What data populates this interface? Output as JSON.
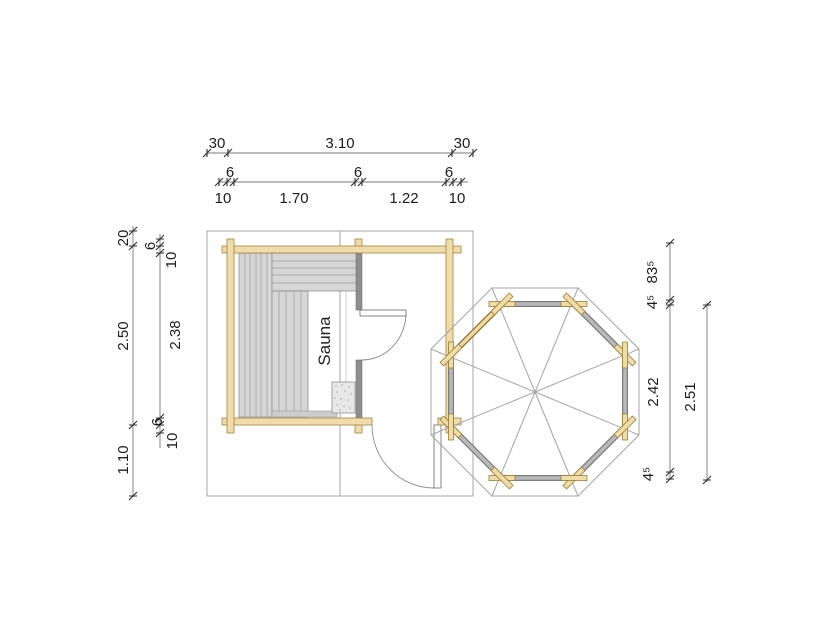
{
  "plan": {
    "room_label": "Sauna"
  },
  "dimensions": {
    "top": {
      "row1": [
        "30",
        "3.10",
        "30"
      ],
      "row2": [
        "6",
        "6",
        "6"
      ],
      "row3": [
        "10",
        "1.70",
        "1.22",
        "10"
      ]
    },
    "left": {
      "outer": [
        "20",
        "2.50",
        "1.10"
      ],
      "inner": [
        "6",
        "10",
        "2.38",
        "6",
        "10"
      ]
    },
    "right": {
      "inner": [
        "83⁵",
        "4⁵",
        "2.42",
        "4⁵"
      ],
      "outer": [
        "2.51"
      ]
    }
  },
  "colors": {
    "wood": "#f0dcaa",
    "wood_border": "#9c7c34",
    "bench_gray": "#d6d6d6",
    "wall_gray": "#8e8e8e",
    "octagon_wall_gray": "#b9b9b9",
    "roof_outline": "#a5a5a5",
    "dimension_text": "#1c1c1c",
    "background": "#ffffff"
  }
}
